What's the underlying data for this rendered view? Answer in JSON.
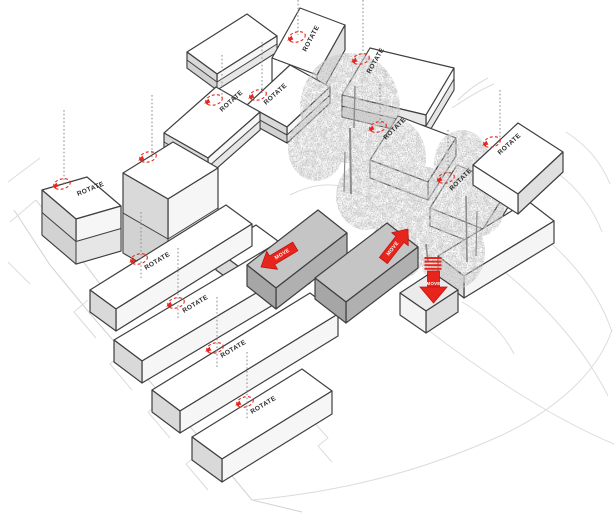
{
  "diagram": {
    "type": "axonometric-site-massing-diagram",
    "labels": {
      "rotate": "ROTATE",
      "move": "MOVE"
    },
    "colors": {
      "accent_red": "#e8251d",
      "building_top": "#ffffff",
      "building_front": "#f6f6f6",
      "building_end": "#d9d9d9",
      "moved_bar_gray": "#c5c5c5",
      "edge": "#3f3f3f",
      "contour": "#d9d9d9",
      "tree_gray": "#8c8c8c",
      "axis_dot_gray": "#8a8a8a"
    },
    "counts": {
      "rotation_markers": 13,
      "rotate_text_labels": 12,
      "move_arrows": 3
    },
    "buildings": [
      {
        "id": "b1",
        "kind": "tower",
        "action": "rotate",
        "label": "ROTATE"
      },
      {
        "id": "b2",
        "kind": "tower",
        "action": "rotate",
        "label": ""
      },
      {
        "id": "b3",
        "kind": "block",
        "action": "rotate",
        "label": "ROTATE"
      },
      {
        "id": "b4",
        "kind": "block",
        "action": "none",
        "label": ""
      },
      {
        "id": "b5",
        "kind": "block",
        "action": "rotate",
        "label": "ROTATE"
      },
      {
        "id": "b6",
        "kind": "block",
        "action": "rotate",
        "label": "ROTATE"
      },
      {
        "id": "b7",
        "kind": "block",
        "action": "rotate",
        "label": "ROTATE"
      },
      {
        "id": "m1",
        "kind": "block",
        "action": "rotate",
        "label": "ROTATE"
      },
      {
        "id": "m2",
        "kind": "block",
        "action": "rotate",
        "label": "ROTATE"
      },
      {
        "id": "b9",
        "kind": "block",
        "action": "rotate",
        "label": "ROTATE"
      },
      {
        "id": "b11",
        "kind": "slab",
        "action": "none",
        "label": ""
      },
      {
        "id": "w1",
        "kind": "slab",
        "action": "none",
        "label": ""
      },
      {
        "id": "s1",
        "kind": "slab",
        "action": "rotate",
        "label": "ROTATE"
      },
      {
        "id": "s2",
        "kind": "slab",
        "action": "rotate",
        "label": "ROTATE"
      },
      {
        "id": "s3",
        "kind": "slab",
        "action": "rotate",
        "label": "ROTATE"
      },
      {
        "id": "s4",
        "kind": "slab",
        "action": "rotate",
        "label": "ROTATE"
      },
      {
        "id": "g1",
        "kind": "gray-bar",
        "action": "move-left",
        "label": "MOVE"
      },
      {
        "id": "g2",
        "kind": "gray-bar",
        "action": "move-right",
        "label": "MOVE"
      },
      {
        "id": "g3",
        "kind": "gray-box",
        "action": "move-down",
        "label": "MOVE"
      }
    ]
  }
}
